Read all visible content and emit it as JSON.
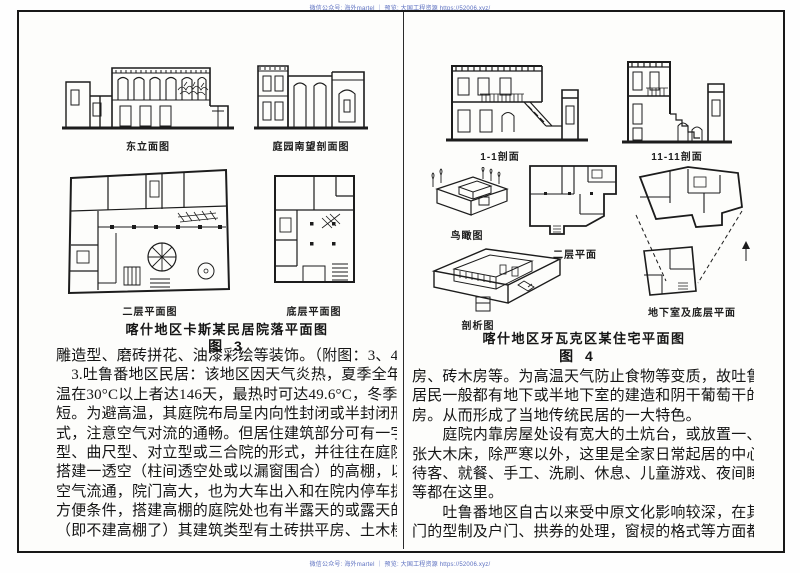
{
  "watermark": {
    "top": "微信公众号: 海外martel ｜ 预览: 大国工程资源 https://52006.xyz/",
    "bottom": "微信公众号: 海外martel ｜ 预览: 大国工程资源 https://52006.xyz/"
  },
  "left_page": {
    "captions": {
      "east_elevation": "东立面图",
      "courtyard_section": "庭园南望剖面图",
      "second_floor_plan": "二层平面图",
      "ground_floor_plan": "底层平面图"
    },
    "figure_title": "喀什地区卡斯某民居院落平面图",
    "figure_number": "图  3",
    "lines": [
      "雕造型、磨砖拼花、油漆彩绘等装饰。（附图：3、4）",
      "　3.吐鲁番地区民居：该地区因天气炎热，夏季全年气",
      "温在30°C以上者达146天，最热时可达49.6°C，冬季较",
      "短。为避高温，其庭院布局呈内向性封闭或半封闭形",
      "式，注意空气对流的通畅。但居住建筑部分可有一字",
      "型、曲尺型、对立型或三合院的形式，并往往在庭院上",
      "搭建一透空（柱间透空处或以漏窗围合）的高棚，以利",
      "空气流通，院门高大，也为大车出入和在院内停车提供",
      "方便条件，搭建高棚的庭院处也有半露天的或露天的",
      "（即不建高棚了）其建筑类型有土砖拱平房、土木楼"
    ]
  },
  "right_page": {
    "captions": {
      "section_1_1": "1-1剖面",
      "section_11_11": "11-11剖面",
      "bird_view": "鸟瞰图",
      "second_floor_plan": "二层平面",
      "basement_ground_plan": "地下室及底层平面",
      "cutaway": "剖析图"
    },
    "figure_title": "喀什地区牙瓦克区某住宅平面图",
    "figure_number": "图  4",
    "lines": [
      "房、砖木房等。为高温天气防止食物等变质，故吐鲁番",
      "居民一般都有地下或半地下室的建造和阴干葡萄干的凉",
      "房。从而形成了当地传统民居的一大特色。",
      "　　庭院内靠房屋处设有宽大的土炕台，或放置一、两",
      "张大木床，除严寒以外，这里是全家日常起居的中心，",
      "待客、就餐、手工、洗刷、休息、儿童游戏、夜间睡眠",
      "等都在这里。",
      "　　吐鲁番地区自古以来受中原文化影响较深，在其大",
      "门的型制及户门、拱券的处理，窗棂的格式等方面都有"
    ]
  }
}
